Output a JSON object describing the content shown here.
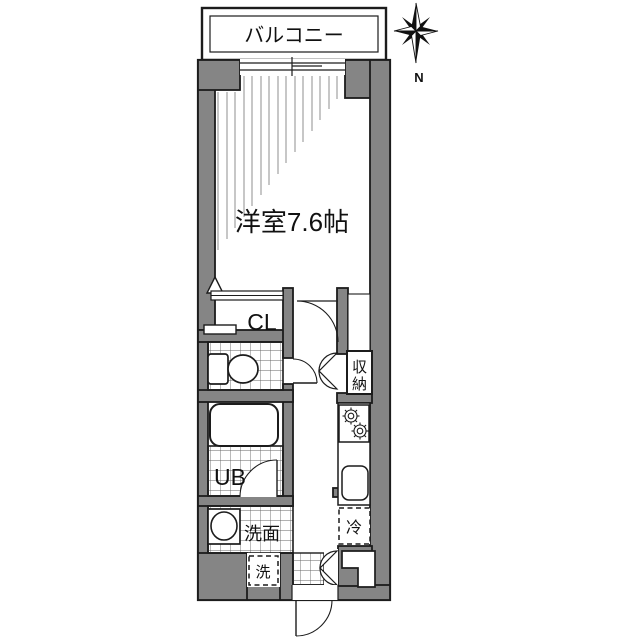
{
  "plan": {
    "balcony": "バルコニー",
    "room": "洋室7.6帖",
    "closet": "CL",
    "storage_top": "収",
    "storage_bottom": "納",
    "unit_bath": "UB",
    "washstand": "洗面",
    "washer": "洗",
    "refrigerator": "冷",
    "compass_north": "N"
  },
  "colors": {
    "wall": "#858585",
    "outline": "#1c1c1c",
    "background": "#ffffff",
    "hatch": "#8f8f8f"
  }
}
